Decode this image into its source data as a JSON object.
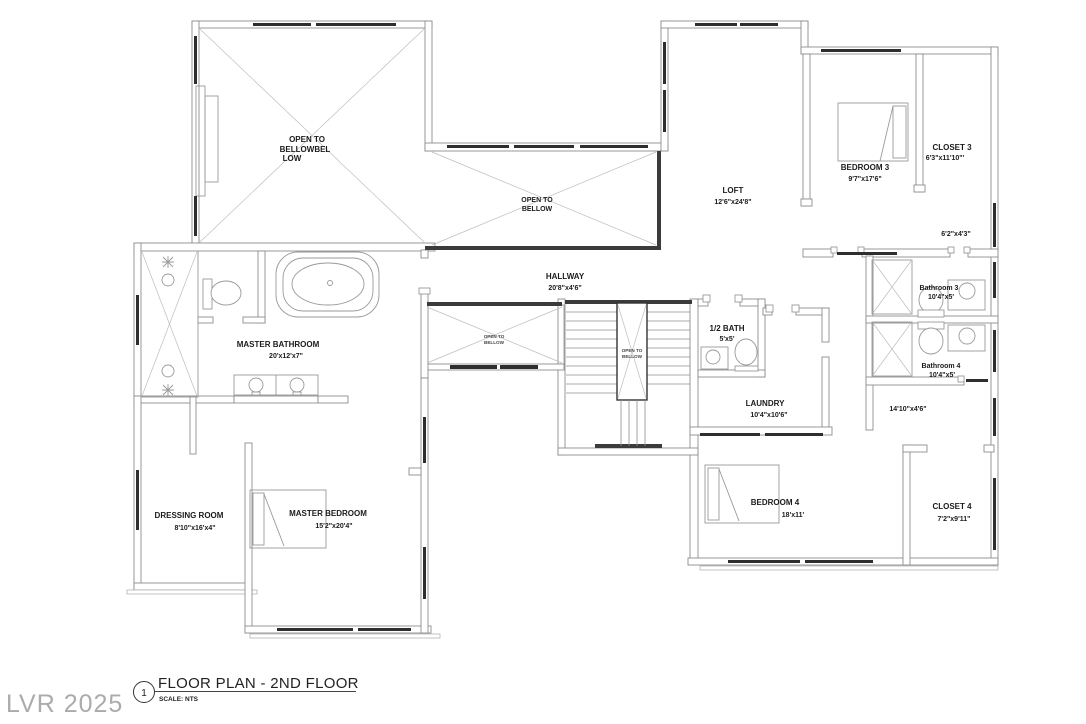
{
  "colors": {
    "wall_line": "#8d8d8d",
    "window_fill": "#2e2e2e",
    "open_edge": "#3b3b3b",
    "label_text": "#1b1b1b",
    "watermark": "#ababab"
  },
  "title_block": {
    "number": "1",
    "title": "FLOOR PLAN - 2ND FLOOR",
    "scale": "SCALE: NTS"
  },
  "watermark": "LVR 2025",
  "rooms": {
    "open_main": {
      "l1": "OPEN TO",
      "l2": "BELLOWBEL",
      "l3": "LOW"
    },
    "open_upper": {
      "l1": "OPEN TO",
      "l2": "BELLOW"
    },
    "open_hall": {
      "l1": "OPEN TO",
      "l2": "BELLOW"
    },
    "open_stair": {
      "l1": "OPEN TO",
      "l2": "BELLOW"
    },
    "loft": {
      "name": "LOFT",
      "dims": "12'6\"x24'8\""
    },
    "bedroom3": {
      "name": "BEDROOM 3",
      "dims": "9'7\"x17'6\""
    },
    "closet3": {
      "name": "CLOSET 3",
      "dims": "6'3\"x11'10\"'"
    },
    "nook": {
      "dims": "6'2\"x4'3\""
    },
    "hallway": {
      "name": "HALLWAY",
      "dims": "20'8\"x4'6\""
    },
    "half_bath": {
      "name": "1/2 BATH",
      "dims": "5'x5'"
    },
    "laundry": {
      "name": "LAUNDRY",
      "dims": "10'4\"x10'6\""
    },
    "bathroom3": {
      "name": "Bathroom 3",
      "dims": "10'4\"x5'"
    },
    "bathroom4": {
      "name": "Bathroom 4",
      "dims": "10'4\"x5'"
    },
    "corridor": {
      "dims": "14'10\"x4'6\""
    },
    "bedroom4": {
      "name": "BEDROOM 4",
      "dims": "18'x11'"
    },
    "closet4": {
      "name": "CLOSET 4",
      "dims": "7'2\"x9'11\""
    },
    "master_bath": {
      "name": "MASTER BATHROOM",
      "dims": "20'x12'x7\""
    },
    "dressing": {
      "name": "DRESSING ROOM",
      "dims": "8'10\"x16'x4\""
    },
    "master_bedroom": {
      "name": "MASTER BEDROOM",
      "dims": "15'2\"x20'4\""
    }
  }
}
